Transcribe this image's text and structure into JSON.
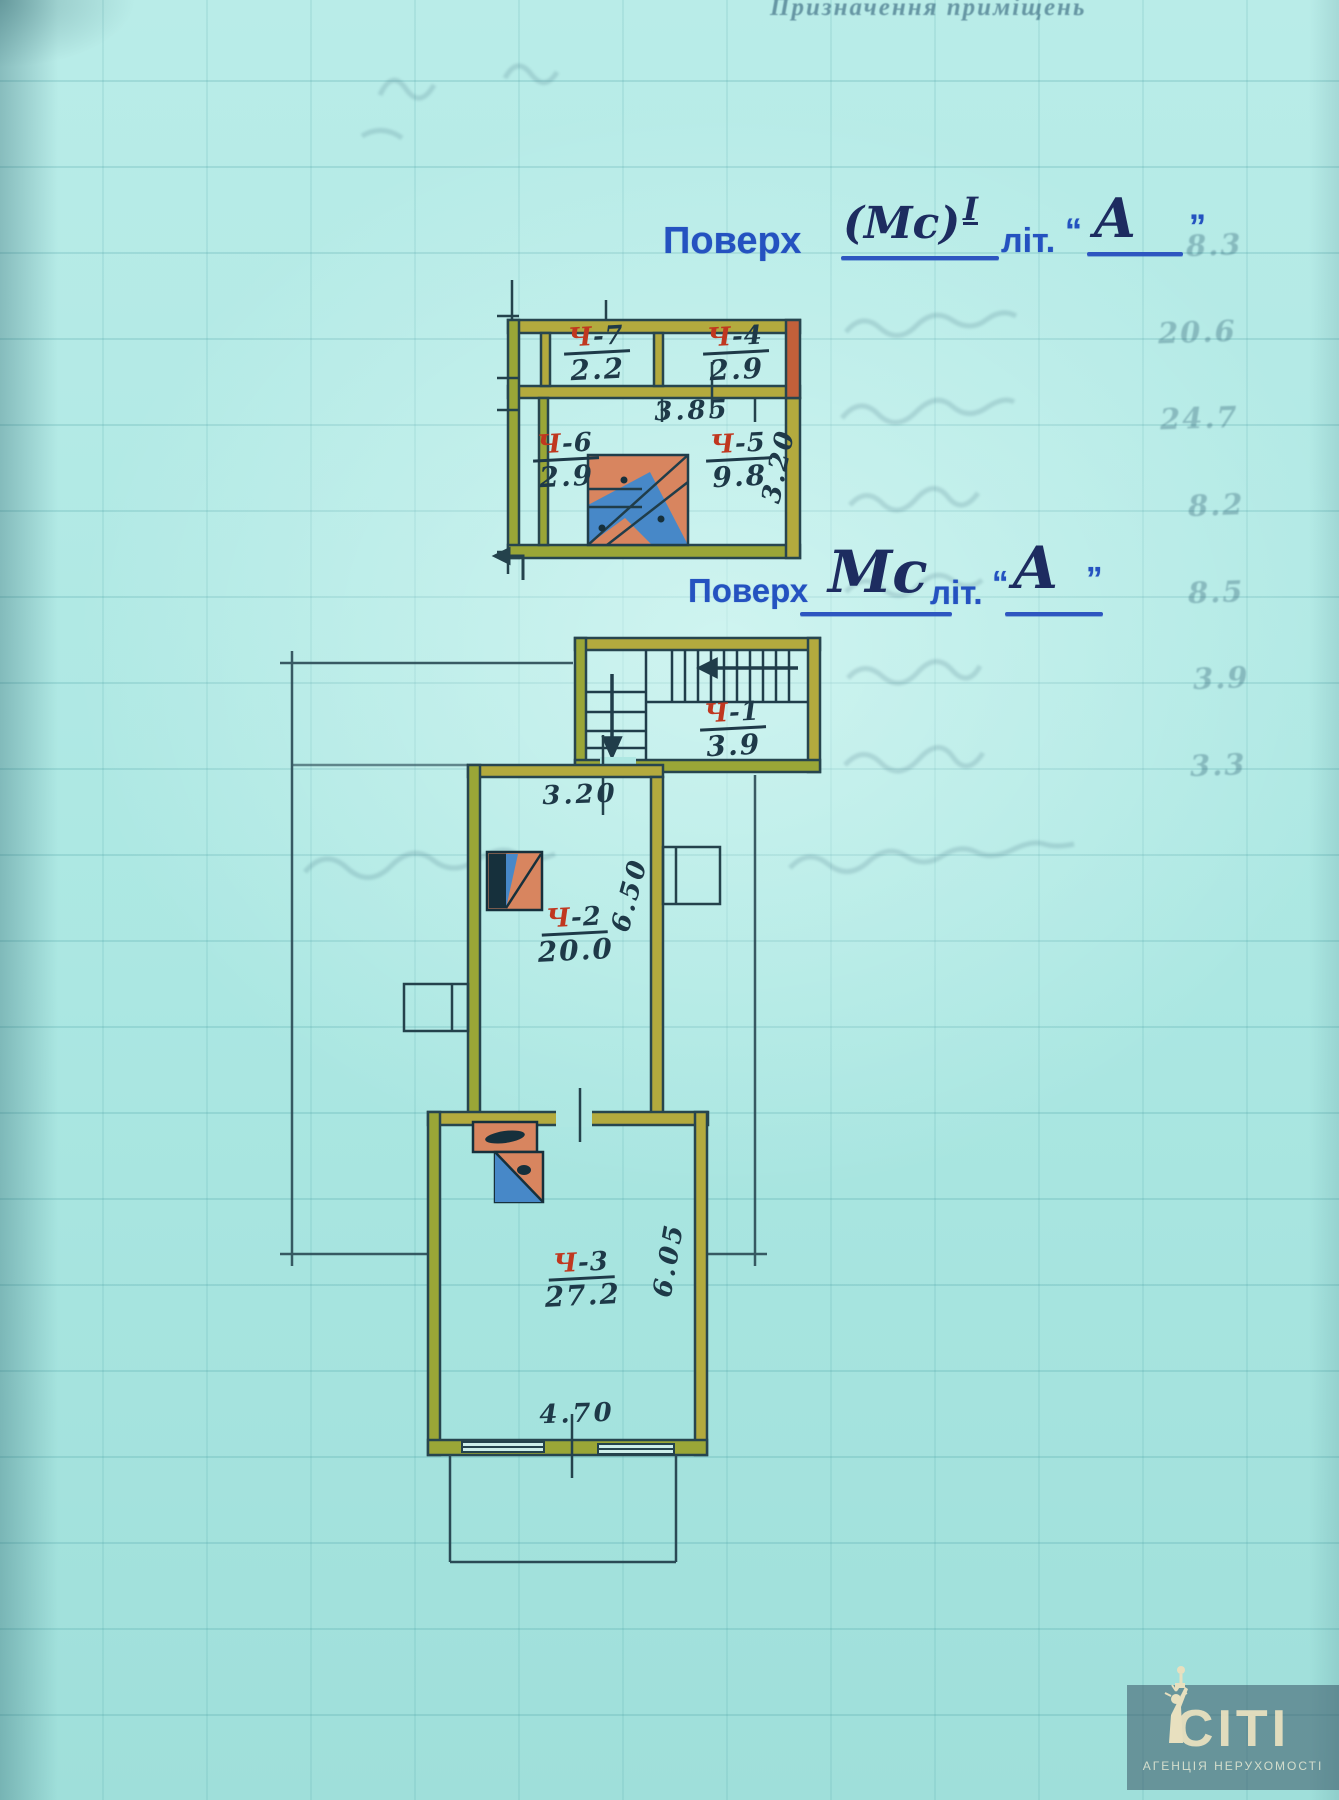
{
  "titles": {
    "floor1": {
      "prefix": "Поверх",
      "hand": "(Мс)",
      "sup": "I",
      "lit": "літ.",
      "quote_open": "“",
      "letter": "А",
      "quote_close": "”"
    },
    "floor2": {
      "prefix": "Поверх",
      "hand": "Мс",
      "lit": "літ.",
      "quote_open": "“",
      "letter": "А",
      "quote_close": "”"
    }
  },
  "mezzanine_plan": {
    "rooms": [
      {
        "letter": "Ч",
        "num": "-7",
        "area": "2.2"
      },
      {
        "letter": "Ч",
        "num": "-4",
        "area": "2.9"
      },
      {
        "letter": "Ч",
        "num": "-6",
        "area": "2.9"
      },
      {
        "letter": "Ч",
        "num": "-5",
        "area": "9.8"
      }
    ],
    "dims": {
      "width": "3.85",
      "depth": "3.20"
    }
  },
  "main_plan": {
    "rooms": [
      {
        "letter": "Ч",
        "num": "-1",
        "area": "3.9"
      },
      {
        "letter": "Ч",
        "num": "-2",
        "area": "20.0"
      },
      {
        "letter": "Ч",
        "num": "-3",
        "area": "27.2"
      }
    ],
    "dims": {
      "hall_width": "3.20",
      "room2_depth": "6.50",
      "room3_depth": "6.05",
      "room3_width": "4.70"
    }
  },
  "ghost_notes": {
    "header": "Призначення приміщень",
    "column_values": [
      "8.3",
      "20.6",
      "24.7",
      "8.2",
      "8.5",
      "3.9",
      "3.3"
    ]
  },
  "watermark": {
    "brand": "СІТІ",
    "subtitle": "АГЕНЦІЯ НЕРУХОМОСТІ"
  },
  "colors": {
    "ink_blue": "#2452c0",
    "hand_ink": "#1d2c60",
    "wall_olive": "#b3aa3e",
    "wall_brick": "#c2603a",
    "stove_orange": "#d8855f",
    "stair_blue": "#4788c8",
    "label_red": "#c0371f",
    "pencil_dark": "#1e3948"
  }
}
